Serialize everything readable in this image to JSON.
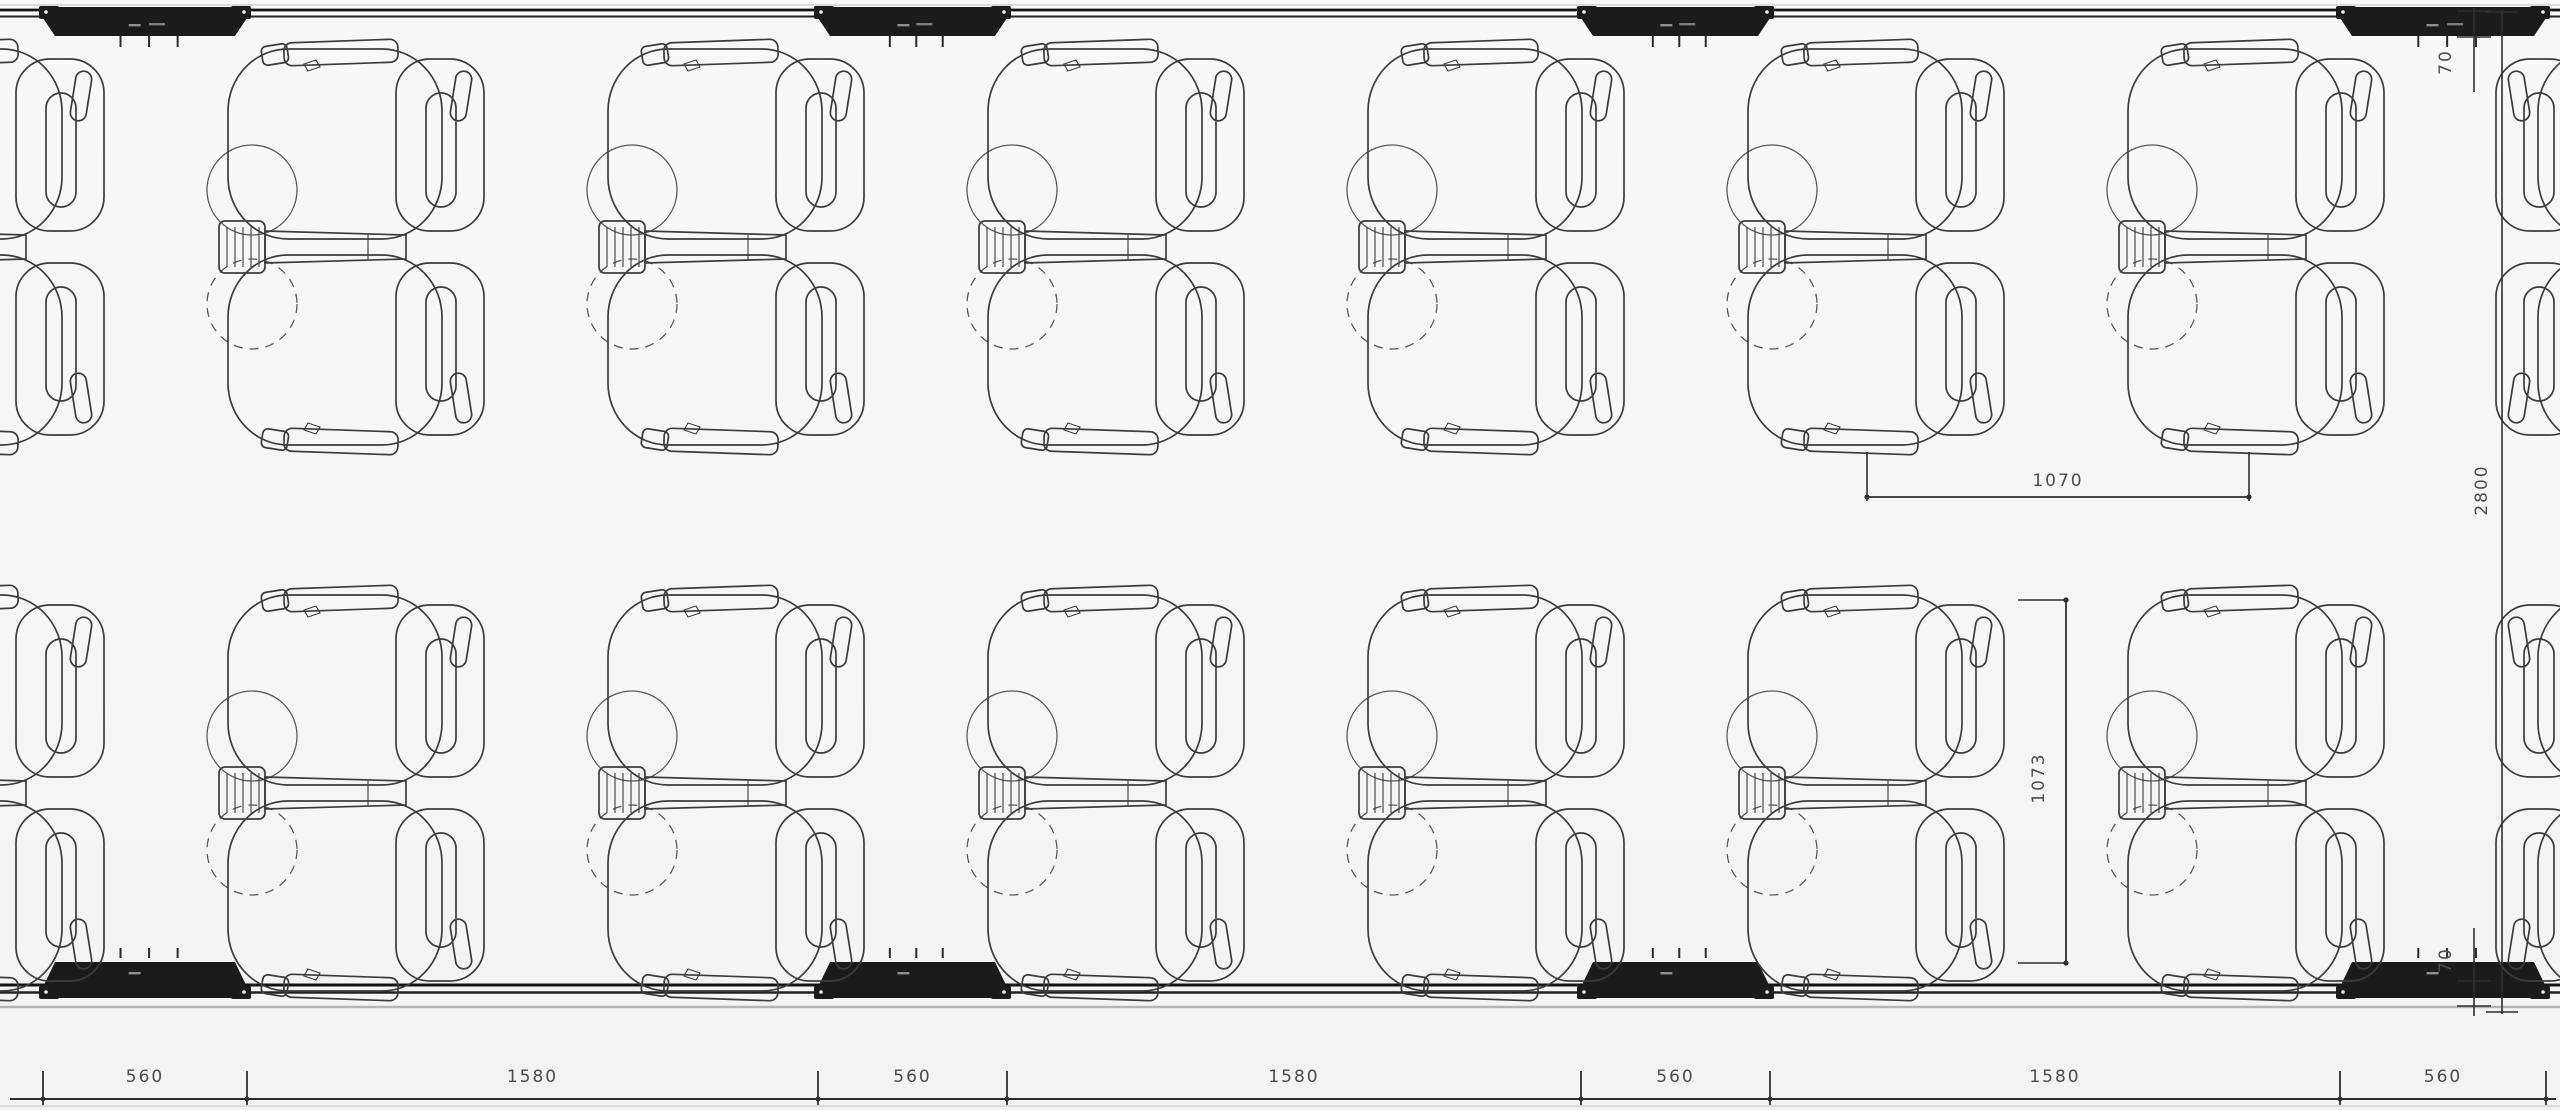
{
  "title": "Seating layout floor plan",
  "dimensions": {
    "bottom_segments": [
      "560",
      "1580",
      "560",
      "1580",
      "560",
      "1580",
      "560"
    ],
    "seat_pitch_horizontal": "1070",
    "seat_bay_depth": "1073",
    "overall_depth": "2800",
    "wall_thickness_top": "70",
    "wall_thickness_bottom": "70"
  },
  "colors": {
    "background": "#f6f6f4",
    "seat_line": "#3c3c3c",
    "wall_dark": "#1b1b1b",
    "dim_line": "#2e2e2e",
    "dim_text": "#4c4c4c",
    "floor_line": "#b5b5b5"
  },
  "layout": {
    "unit_centers_x": [
      -30,
      350,
      730,
      1110,
      1490,
      1870,
      2250
    ],
    "mirrored_unit_center_x": 2630,
    "row_centers_y": [
      247,
      793
    ],
    "wall_segments_x": [
      [
        43,
        247
      ],
      [
        818,
        1007
      ],
      [
        1581,
        1770
      ],
      [
        2340,
        2546
      ]
    ],
    "bottom_dim_ticks_x": [
      43,
      247,
      818,
      1007,
      1581,
      1770,
      2340,
      2546
    ],
    "bottom_dim_line_y": 1099,
    "pitch_dim": {
      "x1": 1867,
      "x2": 2249,
      "y": 497
    },
    "bay_dim": {
      "x": 2066,
      "y1": 600,
      "y2": 963
    },
    "depth_dim": {
      "x": 2502,
      "y1": 10,
      "y2": 1014
    },
    "wall_dim_top": {
      "x": 2474,
      "y1": 8,
      "y2": 92,
      "t1": 11,
      "t2": 37
    },
    "wall_dim_bottom": {
      "x": 2474,
      "y1": 928,
      "y2": 1016,
      "t1": 981,
      "t2": 1006
    }
  }
}
